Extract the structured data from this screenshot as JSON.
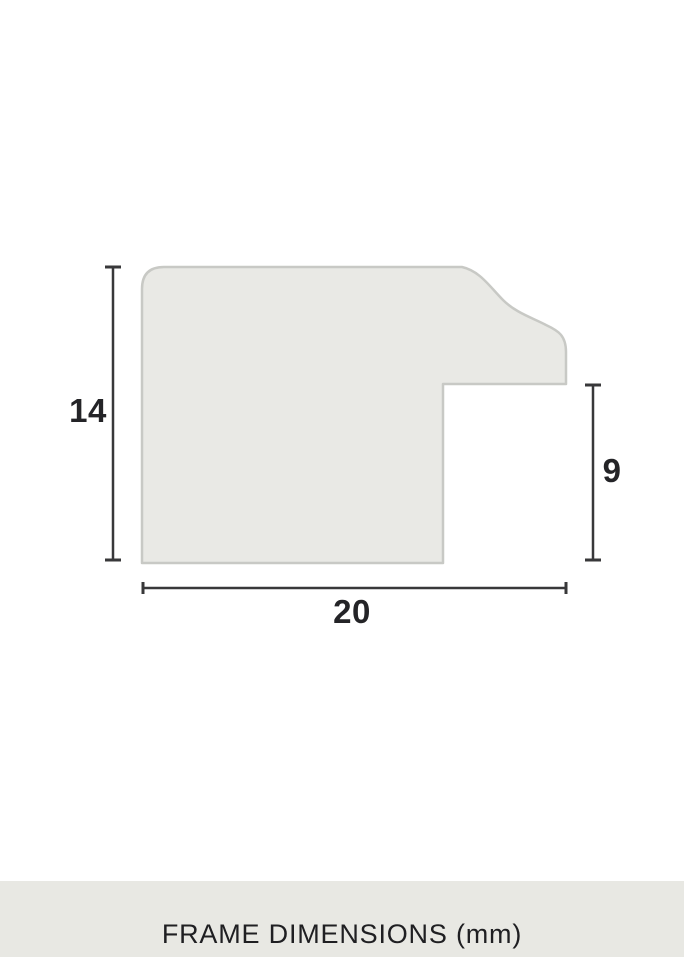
{
  "diagram": {
    "title": "frame moulding cross-section profile",
    "height_label": "14",
    "rebate_label": "9",
    "width_label": "20",
    "colors": {
      "profile_fill": "#e9e9e5",
      "profile_stroke": "#c8c9c5",
      "dimension_line": "#38383a",
      "label_text": "#242427",
      "footer_background": "#e8e8e3",
      "page_background": "#ffffff"
    }
  },
  "footer": {
    "title": "FRAME DIMENSIONS (mm)"
  }
}
